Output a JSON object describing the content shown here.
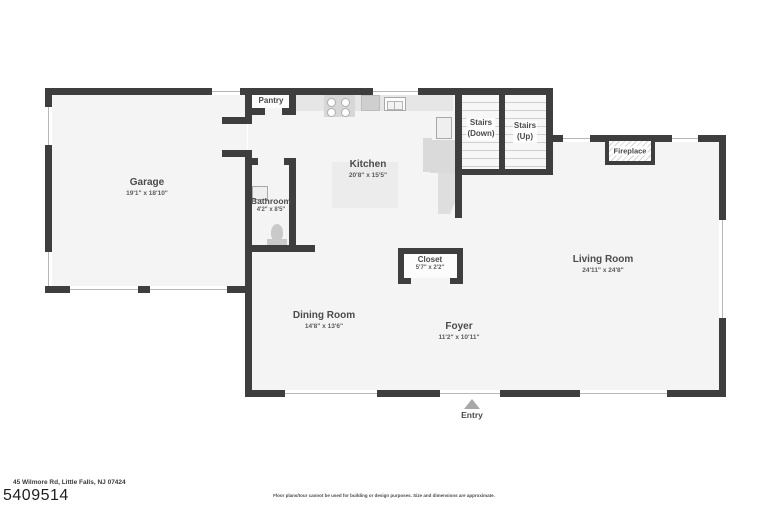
{
  "plan": {
    "rooms": {
      "garage": {
        "name": "Garage",
        "dims": "19'1\" x 18'10\""
      },
      "pantry": {
        "name": "Pantry"
      },
      "kitchen": {
        "name": "Kitchen",
        "dims": "20'8\" x 15'5\""
      },
      "stairs_down": {
        "line1": "Stairs",
        "line2": "(Down)"
      },
      "stairs_up": {
        "line1": "Stairs",
        "line2": "(Up)"
      },
      "fireplace": {
        "name": "Fireplace"
      },
      "bathroom": {
        "name": "Bathroom",
        "dims": "4'2\" x 8'5\""
      },
      "closet": {
        "name": "Closet",
        "dims": "5'7\" x 2'2\""
      },
      "living_room": {
        "name": "Living Room",
        "dims": "24'11\" x 24'8\""
      },
      "dining_room": {
        "name": "Dining Room",
        "dims": "14'8\" x 13'6\""
      },
      "foyer": {
        "name": "Foyer",
        "dims": "11'2\" x 10'11\""
      },
      "entry": {
        "name": "Entry"
      }
    },
    "colors": {
      "wall": "#3e3e3e",
      "floor": "#f4f4f4",
      "fixture": "#dadada",
      "label_text": "#4b4b4b",
      "window_line": "#b7b7b7",
      "entry_arrow": "#a8a8a8"
    }
  },
  "footer": {
    "address": "45 Wilmore Rd, Little Falls, NJ 07424",
    "mls_number": "5409514",
    "disclaimer": "Floor plans/tour cannot be used for building or design purposes. Size and dimensions are approximate."
  }
}
